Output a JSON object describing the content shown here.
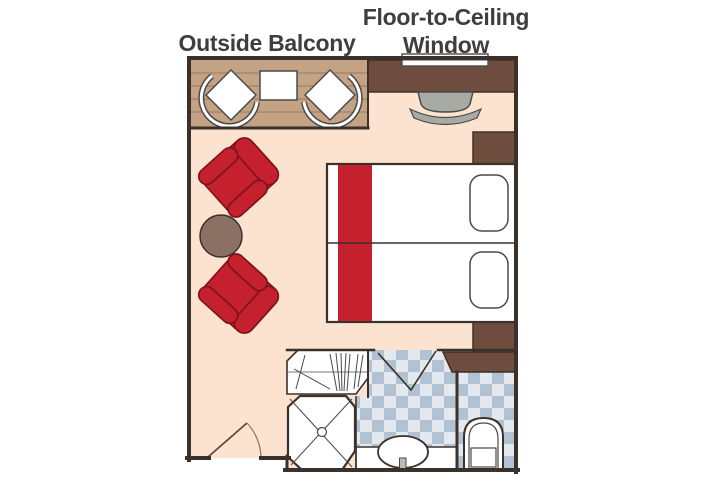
{
  "diagram": {
    "type": "cruise-stateroom-floor-plan",
    "labels": {
      "outside_balcony": "Outside Balcony",
      "window_line1": "Floor-to-Ceiling",
      "window_line2": "Window"
    },
    "rooms": [
      "outside balcony",
      "sleeping and sitting area",
      "bathroom",
      "closet",
      "toilet room"
    ],
    "furniture": [
      "balcony chair left",
      "balcony table",
      "balcony chair right",
      "floor-to-ceiling window",
      "desk counter",
      "desk stool",
      "red armchair upper",
      "red armchair lower",
      "round side table",
      "twin bed upper",
      "twin bed lower",
      "pillow upper",
      "pillow lower",
      "nightstand upper",
      "nightstand lower",
      "cabinet over toilet",
      "closet with hangers",
      "shower",
      "sink counter",
      "sink",
      "toilet",
      "entry door",
      "bathroom folding door"
    ],
    "colors": {
      "label_text": "#3e3e3e",
      "wall": "#3a312a",
      "room_floor": "#fbe3d0",
      "balcony_wood": "#c4a284",
      "balcony_plank_line": "#977b61",
      "cabinet_brown": "#6e4c3e",
      "accent_red": "#c4202e",
      "red_outline": "#7e1119",
      "white": "#ffffff",
      "furniture_outline": "#4a4a4a",
      "table_brown": "#8b7164",
      "stool_gray": "#a8aba3",
      "tile_dark": "#b1c2d2",
      "tile_light": "#e3e9ee",
      "faucet_gray": "#b9bdb9",
      "door_arc": "#8a7465"
    }
  }
}
